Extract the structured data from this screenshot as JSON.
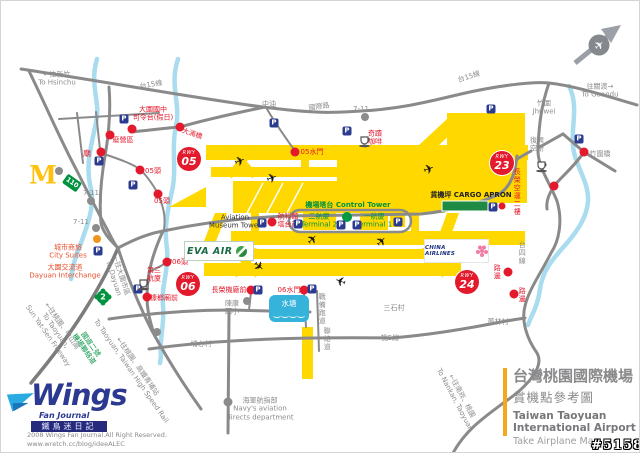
{
  "title_block": {
    "cn1": "台灣桃園國際機場",
    "cn2": "賞機點參考圖",
    "en1": "Taiwan Taoyuan",
    "en2": "International Airport",
    "en3": "Take Airplane Map"
  },
  "branding": {
    "wings_word": "Wings",
    "wings_sub": "Fan Journal",
    "wings_cn": "鐵鳥迷日記"
  },
  "copyright": "2008 Wings Fan Journal.All Right Reserved.\nwww.wretch.cc/blog/ideeALEC",
  "watermark": "#51589",
  "logos": {
    "eva_air": "EVA AIR",
    "china_airlines": "CHINA AIRLINES",
    "mcdonalds": "M"
  },
  "pond_label": "水塘",
  "colors": {
    "runway_yellow": "#FFD800",
    "road_gray": "#8a8a8a",
    "river_blue": "#a8dcee",
    "spot_red": "#e3192c",
    "parking_blue": "#2b3b8f",
    "map_green": "#00923f",
    "accent_orange": "#f5a81c",
    "wings_navy": "#2b3990"
  },
  "map": {
    "parking_glyph": "P",
    "plane_glyph": "✈",
    "badge_word": "RWY",
    "badges": [
      {
        "n": "rwy-05-badge",
        "num": "05",
        "x": 188,
        "y": 158
      },
      {
        "n": "rwy-23-badge",
        "num": "23",
        "x": 501,
        "y": 162
      },
      {
        "n": "rwy-06-badge",
        "num": "06",
        "x": 187,
        "y": 283
      },
      {
        "n": "rwy-24-badge",
        "num": "24",
        "x": 466,
        "y": 281
      }
    ],
    "shields": [
      {
        "n": "route-110-shield",
        "text": "110",
        "x": 71,
        "y": 182,
        "shape": "rect"
      },
      {
        "n": "freeway-2-shield",
        "text": "2",
        "x": 102,
        "y": 296,
        "shape": "flower"
      }
    ],
    "labels": [
      {
        "n": "to-hsinchu-label",
        "text": "←往新竹\nTo Hsinchu",
        "x": 56,
        "y": 78,
        "c": "#8c8c8c"
      },
      {
        "n": "route-tai15-nw-label",
        "text": "台15線",
        "x": 150,
        "y": 84,
        "c": "#8c8c8c",
        "rot": -10
      },
      {
        "n": "cpc-gas-label",
        "text": "中油",
        "x": 268,
        "y": 103,
        "c": "#8c8c8c"
      },
      {
        "n": "intl-road-label",
        "text": "國際路",
        "x": 318,
        "y": 106,
        "c": "#8c8c8c",
        "rot": -8
      },
      {
        "n": "seven-eleven-north-label",
        "text": "7-11",
        "x": 360,
        "y": 108,
        "c": "#8c8c8c"
      },
      {
        "n": "route-tai15-ne-label",
        "text": "台15線",
        "x": 468,
        "y": 76,
        "c": "#8c8c8c",
        "rot": -18
      },
      {
        "n": "jhuwei-label",
        "text": "竹圍\nJhuwei",
        "x": 543,
        "y": 107,
        "c": "#8c8c8c"
      },
      {
        "n": "to-guandu-label",
        "text": "往關渡→\nTo Guandu",
        "x": 599,
        "y": 90,
        "c": "#8c8c8c"
      },
      {
        "n": "dayuan-junior-high-label",
        "text": "大園國中\n司令台(假日)",
        "x": 152,
        "y": 113,
        "c": "#e3192c"
      },
      {
        "n": "abandoned-camp-label",
        "text": "廢營區",
        "x": 122,
        "y": 139,
        "c": "#e3192c"
      },
      {
        "n": "temple-label",
        "text": "廟",
        "x": 86,
        "y": 153,
        "c": "#e3192c",
        "s": 8
      },
      {
        "n": "rwy05-head-1-label",
        "text": "05頭",
        "x": 152,
        "y": 170,
        "c": "#e3192c"
      },
      {
        "n": "rwy05-head-2-label",
        "text": "05頭",
        "x": 161,
        "y": 200,
        "c": "#e3192c"
      },
      {
        "n": "danan-bridge-label",
        "text": "大湳橋",
        "x": 191,
        "y": 133,
        "c": "#e3192c",
        "rot": 18
      },
      {
        "n": "rwy05-sluice-label",
        "text": "05水門",
        "x": 311,
        "y": 151,
        "c": "#e3192c"
      },
      {
        "n": "miracle-coffee-label",
        "text": "奇蹟\n咖啡",
        "x": 374,
        "y": 137,
        "c": "#e3192c"
      },
      {
        "n": "seven-eleven-west-label",
        "text": "7-11",
        "x": 90,
        "y": 192,
        "c": "#8c8c8c"
      },
      {
        "n": "seven-eleven-sw-label",
        "text": "7-11",
        "x": 80,
        "y": 221,
        "c": "#8c8c8c"
      },
      {
        "n": "city-suites-label",
        "text": "城市商旅\nCity Suites",
        "x": 67,
        "y": 251,
        "c": "#e8502d"
      },
      {
        "n": "dayuan-interchange-label",
        "text": "大園交流道\nDayuan Interchange",
        "x": 64,
        "y": 271,
        "c": "#e8502d"
      },
      {
        "n": "to-dayuan-label",
        "text": "←往大園市區\nTo Dayuan",
        "x": 116,
        "y": 276,
        "c": "#8c8c8c",
        "rot": 72
      },
      {
        "n": "freeway2-name-label",
        "text": "國道二號\n機場聯絡道",
        "x": 86,
        "y": 346,
        "c": "#00923f",
        "rot": 55
      },
      {
        "n": "to-sun-yat-sen-freeway-label",
        "text": "←往桃園、中山高\nTo Taoyuan,\nSun Yat-Sen Freeway",
        "x": 54,
        "y": 330,
        "c": "#8c8c8c",
        "rot": 55
      },
      {
        "n": "to-hsr-label",
        "text": "←往桃園、高鐵青埔站\nTo Taoyuan, Taiwan High Speed Rail",
        "x": 133,
        "y": 368,
        "c": "#8c8c8c",
        "rot": 55
      },
      {
        "n": "terminal3-label",
        "text": "第三\n航廈",
        "x": 153,
        "y": 274,
        "c": "#e3192c"
      },
      {
        "n": "kanglang-temple-label",
        "text": "槺榔廟前",
        "x": 163,
        "y": 297,
        "c": "#e3192c"
      },
      {
        "n": "rwy06-head-label",
        "text": "06頭",
        "x": 179,
        "y": 261,
        "c": "#e3192c"
      },
      {
        "n": "eva-hangar-label",
        "text": "長榮機廠前",
        "x": 228,
        "y": 289,
        "c": "#e3192c"
      },
      {
        "n": "rwy06-sluice-label",
        "text": "06水門",
        "x": 288,
        "y": 289,
        "c": "#e3192c"
      },
      {
        "n": "chenkang-elementary-label",
        "text": "陳康\n國小",
        "x": 231,
        "y": 307,
        "c": "#8c8c8c"
      },
      {
        "n": "puxin-village-label",
        "text": "埔心村",
        "x": 200,
        "y": 343,
        "c": "#8c8c8c"
      },
      {
        "n": "navy-aviation-label",
        "text": "海軍航指部\nNavy's aviation\ndirects department",
        "x": 259,
        "y": 408,
        "c": "#8c8c8c"
      },
      {
        "n": "reserve-runway-label",
        "text": "戰備跑道",
        "x": 321,
        "y": 308,
        "c": "#8c8c8c",
        "vert": true
      },
      {
        "n": "link-road-label",
        "text": "聯絡道",
        "x": 326,
        "y": 338,
        "c": "#8c8c8c",
        "vert": true
      },
      {
        "n": "aviation-museum-label",
        "text": "Aviation\nMuseum Tower",
        "x": 234,
        "y": 221,
        "c": "#333333"
      },
      {
        "n": "aviation-science-tower-label",
        "text": "航科館\n塔台前",
        "x": 287,
        "y": 220,
        "c": "#e3192c"
      },
      {
        "n": "control-tower-label",
        "text": "機場塔台 Control Tower",
        "x": 347,
        "y": 204,
        "c": "#00923f",
        "b": true
      },
      {
        "n": "terminal2-label",
        "text": "二航廈\nTerminal 2",
        "x": 318,
        "y": 220,
        "c": "#00923f"
      },
      {
        "n": "terminal1-label",
        "text": "一航廈\nTerminal 1",
        "x": 373,
        "y": 220,
        "c": "#00923f"
      },
      {
        "n": "cargo-apron-label",
        "text": "貨機坪 CARGO APRON",
        "x": 470,
        "y": 194,
        "c": "#222222",
        "b": true
      },
      {
        "n": "eva-cargo-2f-label",
        "text": "長榮空運二樓",
        "x": 516,
        "y": 191,
        "c": "#e3192c",
        "vert": true
      },
      {
        "n": "catering-label",
        "text": "復興\n空廚",
        "x": 536,
        "y": 144,
        "c": "#8c8c8c"
      },
      {
        "n": "zhuwei-bridge-label",
        "text": "竹圍橋",
        "x": 599,
        "y": 153,
        "c": "#8c8c8c"
      },
      {
        "n": "roadside-1-label",
        "text": "路邊",
        "x": 496,
        "y": 271,
        "c": "#e3192c",
        "vert": true
      },
      {
        "n": "roadside-2-label",
        "text": "路邊",
        "x": 521,
        "y": 294,
        "c": "#e3192c",
        "vert": true
      },
      {
        "n": "route-tai4-label",
        "text": "台四線",
        "x": 521,
        "y": 252,
        "c": "#8c8c8c",
        "vert": true
      },
      {
        "n": "sanshi-village-label",
        "text": "三石村",
        "x": 393,
        "y": 307,
        "c": "#8c8c8c"
      },
      {
        "n": "guolin-village-label",
        "text": "菓林村",
        "x": 497,
        "y": 321,
        "c": "#8c8c8c"
      },
      {
        "n": "route-tao5-label",
        "text": "桃5線",
        "x": 389,
        "y": 337,
        "c": "#8c8c8c"
      },
      {
        "n": "to-nankan-label",
        "text": "←往南崁、桃園\nTo Nankan, Taoyuan",
        "x": 457,
        "y": 397,
        "c": "#8c8c8c",
        "rot": 62
      }
    ],
    "dots": [
      {
        "n": "dayuan-jh-dot",
        "x": 131,
        "y": 128,
        "c": "#e3192c",
        "r": 4.5
      },
      {
        "n": "abandoned-camp-dot",
        "x": 109,
        "y": 134,
        "c": "#e3192c",
        "r": 4.5
      },
      {
        "n": "temple-dot",
        "x": 100,
        "y": 151,
        "c": "#e3192c",
        "r": 4.5
      },
      {
        "n": "rwy05-head-1-dot",
        "x": 139,
        "y": 169,
        "c": "#e3192c",
        "r": 4.5
      },
      {
        "n": "rwy05-head-2-dot",
        "x": 157,
        "y": 193,
        "c": "#e3192c",
        "r": 4.5
      },
      {
        "n": "danan-bridge-dot",
        "x": 179,
        "y": 126,
        "c": "#e3192c",
        "r": 4.5
      },
      {
        "n": "rwy05-sluice-dot",
        "x": 294,
        "y": 151,
        "c": "#e3192c",
        "r": 4.5
      },
      {
        "n": "museum-tower-dot",
        "x": 271,
        "y": 221,
        "c": "#e3192c",
        "r": 4.5
      },
      {
        "n": "rwy06-head-dot",
        "x": 166,
        "y": 261,
        "c": "#e3192c",
        "r": 4.5
      },
      {
        "n": "kanglang-temple-dot",
        "x": 146,
        "y": 296,
        "c": "#e3192c",
        "r": 4.5
      },
      {
        "n": "eva-hangar-dot",
        "x": 250,
        "y": 289,
        "c": "#e3192c",
        "r": 4.5
      },
      {
        "n": "rwy06-sluice-dot",
        "x": 303,
        "y": 289,
        "c": "#e3192c",
        "r": 4.5
      },
      {
        "n": "zhuwei-bridge-dot",
        "x": 583,
        "y": 151,
        "c": "#e3192c",
        "r": 4.5
      },
      {
        "n": "east-road-dot",
        "x": 553,
        "y": 185,
        "c": "#e3192c",
        "r": 4.5
      },
      {
        "n": "roadside-1-dot",
        "x": 507,
        "y": 271,
        "c": "#e3192c",
        "r": 4.5
      },
      {
        "n": "roadside-2-dot",
        "x": 513,
        "y": 293,
        "c": "#e3192c",
        "r": 4.5
      },
      {
        "n": "cargo-bar-dot",
        "x": 501,
        "y": 205,
        "c": "#e3192c",
        "r": 3.5
      },
      {
        "n": "mcdonalds-dot",
        "x": 58,
        "y": 170,
        "c": "#8c8c8c",
        "r": 4
      },
      {
        "n": "seven-eleven-west-dot",
        "x": 90,
        "y": 200,
        "c": "#8c8c8c",
        "r": 4
      },
      {
        "n": "seven-eleven-sw-dot",
        "x": 95,
        "y": 227,
        "c": "#8c8c8c",
        "r": 4
      },
      {
        "n": "seven-eleven-north-dot",
        "x": 364,
        "y": 116,
        "c": "#8c8c8c",
        "r": 4
      },
      {
        "n": "chenkang-dot",
        "x": 246,
        "y": 300,
        "c": "#8c8c8c",
        "r": 4
      },
      {
        "n": "navy-dot",
        "x": 227,
        "y": 401,
        "c": "#8c8c8c",
        "r": 4.5
      },
      {
        "n": "junction-dot",
        "x": 156,
        "y": 331,
        "c": "#8c8c8c",
        "r": 4
      },
      {
        "n": "city-suites-dot",
        "x": 96,
        "y": 238,
        "c": "#f0941d",
        "r": 4
      },
      {
        "n": "tower-green-dot",
        "x": 346,
        "y": 216,
        "c": "#009a44",
        "r": 5
      }
    ],
    "parkings": [
      {
        "x": 123,
        "y": 118
      },
      {
        "x": 98,
        "y": 160
      },
      {
        "x": 132,
        "y": 184
      },
      {
        "x": 273,
        "y": 122
      },
      {
        "x": 346,
        "y": 130
      },
      {
        "x": 490,
        "y": 108
      },
      {
        "x": 97,
        "y": 250
      },
      {
        "x": 137,
        "y": 288
      },
      {
        "x": 257,
        "y": 289
      },
      {
        "x": 311,
        "y": 288
      },
      {
        "x": 261,
        "y": 222
      },
      {
        "x": 297,
        "y": 223
      },
      {
        "x": 340,
        "y": 224
      },
      {
        "x": 356,
        "y": 224
      },
      {
        "x": 397,
        "y": 221
      },
      {
        "x": 492,
        "y": 206
      },
      {
        "x": 578,
        "y": 138
      }
    ],
    "cups": [
      {
        "n": "miracle-coffee-icon",
        "x": 357,
        "y": 134
      },
      {
        "n": "terminal3-cafe-icon",
        "x": 136,
        "y": 277
      },
      {
        "n": "catering-icon",
        "x": 534,
        "y": 159
      }
    ],
    "planes": [
      {
        "x": 239,
        "y": 161,
        "rot": -20
      },
      {
        "x": 271,
        "y": 178,
        "rot": -20
      },
      {
        "x": 428,
        "y": 169,
        "rot": -20
      },
      {
        "x": 312,
        "y": 239,
        "rot": -45
      },
      {
        "x": 381,
        "y": 241,
        "rot": -45
      },
      {
        "x": 340,
        "y": 279,
        "rot": 200
      },
      {
        "x": 257,
        "y": 266,
        "rot": 40
      }
    ]
  }
}
